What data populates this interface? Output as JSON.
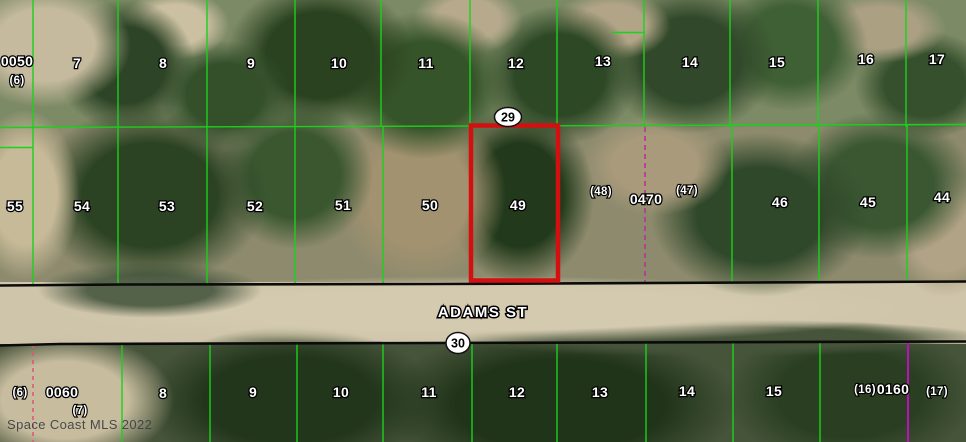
{
  "watermark": "Space Coast MLS 2022",
  "road": {
    "name": "ADAMS ST"
  },
  "block_markers": {
    "top": "29",
    "bottom": "30"
  },
  "lots": {
    "top_row": [
      "0050",
      "(6)",
      "7",
      "8",
      "9",
      "10",
      "11",
      "12",
      "13",
      "14",
      "15",
      "16",
      "17"
    ],
    "middle_row": [
      "55",
      "54",
      "53",
      "52",
      "51",
      "50",
      "49",
      "(48)",
      "0470",
      "(47)",
      "46",
      "45",
      "44"
    ],
    "bottom_row": [
      "(6)",
      "0060",
      "(7)",
      "8",
      "9",
      "10",
      "11",
      "12",
      "13",
      "14",
      "15",
      "(16)",
      "0160",
      "(17)"
    ]
  },
  "colors": {
    "parcel_line": "#1bd11b",
    "highlight": "#d40f0f",
    "road_edge": "#0b0b0b",
    "dashed_magenta": "#bf2f9a",
    "dashed_red": "#df5878",
    "solid_magenta": "#bd10bd",
    "label_fill": "#ffffff",
    "label_halo": "#000000"
  }
}
